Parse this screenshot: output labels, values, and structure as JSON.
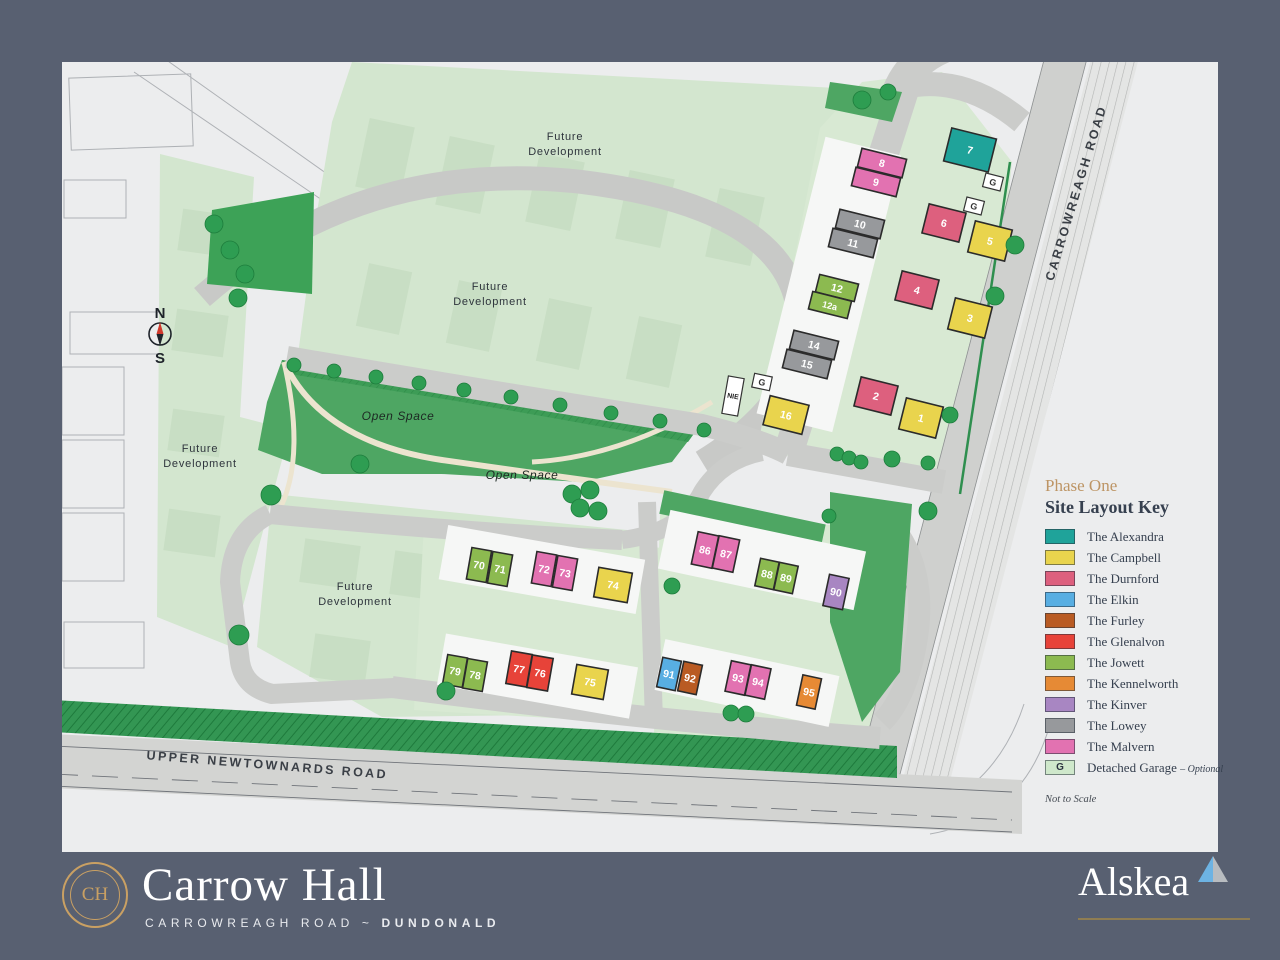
{
  "page": {
    "frame_color": "#586071",
    "map_bg": "#ecedee"
  },
  "legend": {
    "phase": "Phase One",
    "title": "Site Layout Key",
    "items": [
      {
        "name": "The Alexandra",
        "color": "#1fa39a"
      },
      {
        "name": "The Campbell",
        "color": "#e9d44d"
      },
      {
        "name": "The Durnford",
        "color": "#dd607e"
      },
      {
        "name": "The Elkin",
        "color": "#58aee2"
      },
      {
        "name": "The Furley",
        "color": "#b95b23"
      },
      {
        "name": "The Glenalvon",
        "color": "#e74339"
      },
      {
        "name": "The Jowett",
        "color": "#8cba50"
      },
      {
        "name": "The Kennelworth",
        "color": "#e68a35"
      },
      {
        "name": "The Kinver",
        "color": "#a886c2"
      },
      {
        "name": "The Lowey",
        "color": "#97999c"
      },
      {
        "name": "The Malvern",
        "color": "#e272b1"
      }
    ],
    "garage": {
      "label": "Detached Garage",
      "suffix": "– Optional",
      "symbol": "G",
      "color": "#cfe8cb"
    },
    "note": "Not to Scale"
  },
  "footer": {
    "brand": "Carrow Hall",
    "monogram": "CH",
    "tagline_road": "CARROWREAGH ROAD",
    "tagline_sep": "~",
    "tagline_town": "DUNDONALD",
    "developer": "Alskea",
    "accent_gold": "#c9a063",
    "triangle_blue": "#6db3e3",
    "triangle_gray": "#b8bcc0"
  },
  "map": {
    "labels": {
      "future_development": "Future Development",
      "open_space": "Open Space",
      "carrowreagh_road": "CARROWREAGH ROAD",
      "upper_newtownards_road": "UPPER NEWTOWNARDS ROAD",
      "substation": "NIE",
      "garage_symbol": "G",
      "compass_n": "N",
      "compass_s": "S"
    },
    "future_label_positions": [
      {
        "x": 503,
        "y": 78
      },
      {
        "x": 428,
        "y": 228
      },
      {
        "x": 138,
        "y": 390
      },
      {
        "x": 293,
        "y": 528
      }
    ],
    "open_label_positions": [
      {
        "x": 336,
        "y": 358
      },
      {
        "x": 460,
        "y": 417
      }
    ],
    "house_colors": {
      "alexandra": "#1fa39a",
      "campbell": "#e9d44d",
      "durnford": "#dd607e",
      "elkin": "#58aee2",
      "furley": "#b95b23",
      "glenalvon": "#e74339",
      "jowett": "#8cba50",
      "kennelworth": "#e68a35",
      "kinver": "#a886c2",
      "lowey": "#97999c",
      "malvern": "#e272b1"
    },
    "plots": [
      {
        "n": "1",
        "type": "campbell",
        "x": 859,
        "y": 356,
        "w": 38,
        "h": 32,
        "r": 14
      },
      {
        "n": "2",
        "type": "durnford",
        "x": 814,
        "y": 334,
        "w": 38,
        "h": 30,
        "r": 14
      },
      {
        "n": "3",
        "type": "campbell",
        "x": 908,
        "y": 256,
        "w": 38,
        "h": 32,
        "r": 14
      },
      {
        "n": "4",
        "type": "durnford",
        "x": 855,
        "y": 228,
        "w": 38,
        "h": 30,
        "r": 14
      },
      {
        "n": "5",
        "type": "campbell",
        "x": 928,
        "y": 179,
        "w": 38,
        "h": 32,
        "r": 14
      },
      {
        "n": "6",
        "type": "durnford",
        "x": 882,
        "y": 161,
        "w": 38,
        "h": 30,
        "r": 14
      },
      {
        "n": "7",
        "type": "alexandra",
        "x": 908,
        "y": 88,
        "w": 46,
        "h": 34,
        "r": 14
      },
      {
        "n": "8",
        "type": "malvern",
        "x": 820,
        "y": 101,
        "w": 46,
        "h": 19,
        "r": 14
      },
      {
        "n": "9",
        "type": "malvern",
        "x": 814,
        "y": 120,
        "w": 46,
        "h": 19,
        "r": 14
      },
      {
        "n": "10",
        "type": "lowey",
        "x": 798,
        "y": 162,
        "w": 46,
        "h": 19,
        "r": 14
      },
      {
        "n": "11",
        "type": "lowey",
        "x": 791,
        "y": 181,
        "w": 46,
        "h": 19,
        "r": 14
      },
      {
        "n": "12",
        "type": "jowett",
        "x": 775,
        "y": 226,
        "w": 40,
        "h": 18,
        "r": 14
      },
      {
        "n": "12a",
        "type": "jowett",
        "x": 768,
        "y": 243,
        "w": 40,
        "h": 18,
        "r": 14
      },
      {
        "n": "14",
        "type": "lowey",
        "x": 752,
        "y": 283,
        "w": 46,
        "h": 19,
        "r": 14
      },
      {
        "n": "15",
        "type": "lowey",
        "x": 745,
        "y": 302,
        "w": 46,
        "h": 19,
        "r": 14
      },
      {
        "n": "16",
        "type": "campbell",
        "x": 724,
        "y": 353,
        "w": 40,
        "h": 30,
        "r": 14
      },
      {
        "n": "70",
        "type": "jowett",
        "x": 417,
        "y": 503,
        "w": 20,
        "h": 32,
        "r": 10
      },
      {
        "n": "71",
        "type": "jowett",
        "x": 438,
        "y": 507,
        "w": 20,
        "h": 32,
        "r": 10
      },
      {
        "n": "72",
        "type": "malvern",
        "x": 482,
        "y": 507,
        "w": 20,
        "h": 32,
        "r": 10
      },
      {
        "n": "73",
        "type": "malvern",
        "x": 503,
        "y": 511,
        "w": 20,
        "h": 32,
        "r": 10
      },
      {
        "n": "74",
        "type": "campbell",
        "x": 551,
        "y": 523,
        "w": 34,
        "h": 30,
        "r": 10
      },
      {
        "n": "75",
        "type": "campbell",
        "x": 528,
        "y": 620,
        "w": 32,
        "h": 30,
        "r": 10
      },
      {
        "n": "76",
        "type": "glenalvon",
        "x": 478,
        "y": 611,
        "w": 21,
        "h": 33,
        "r": 10
      },
      {
        "n": "77",
        "type": "glenalvon",
        "x": 457,
        "y": 607,
        "w": 21,
        "h": 33,
        "r": 10
      },
      {
        "n": "78",
        "type": "jowett",
        "x": 413,
        "y": 613,
        "w": 20,
        "h": 30,
        "r": 10
      },
      {
        "n": "79",
        "type": "jowett",
        "x": 393,
        "y": 609,
        "w": 20,
        "h": 30,
        "r": 10
      },
      {
        "n": "86",
        "type": "malvern",
        "x": 643,
        "y": 488,
        "w": 21,
        "h": 33,
        "r": 12
      },
      {
        "n": "87",
        "type": "malvern",
        "x": 664,
        "y": 492,
        "w": 21,
        "h": 33,
        "r": 12
      },
      {
        "n": "88",
        "type": "jowett",
        "x": 705,
        "y": 512,
        "w": 19,
        "h": 28,
        "r": 12
      },
      {
        "n": "89",
        "type": "jowett",
        "x": 724,
        "y": 516,
        "w": 19,
        "h": 28,
        "r": 12
      },
      {
        "n": "90",
        "type": "kinver",
        "x": 774,
        "y": 530,
        "w": 20,
        "h": 32,
        "r": 12
      },
      {
        "n": "91",
        "type": "elkin",
        "x": 607,
        "y": 612,
        "w": 19,
        "h": 30,
        "r": 12
      },
      {
        "n": "92",
        "type": "furley",
        "x": 628,
        "y": 616,
        "w": 19,
        "h": 30,
        "r": 12
      },
      {
        "n": "93",
        "type": "malvern",
        "x": 676,
        "y": 616,
        "w": 20,
        "h": 31,
        "r": 12
      },
      {
        "n": "94",
        "type": "malvern",
        "x": 696,
        "y": 620,
        "w": 20,
        "h": 31,
        "r": 12
      },
      {
        "n": "95",
        "type": "kennelworth",
        "x": 747,
        "y": 630,
        "w": 19,
        "h": 31,
        "r": 12
      }
    ],
    "garages": [
      {
        "x": 931,
        "y": 120,
        "r": 14
      },
      {
        "x": 912,
        "y": 144,
        "r": 14
      },
      {
        "x": 700,
        "y": 320,
        "r": 12
      }
    ],
    "substation_box": {
      "x": 671,
      "y": 334,
      "r": 10
    },
    "trees": [
      [
        152,
        162,
        9
      ],
      [
        168,
        188,
        9
      ],
      [
        183,
        212,
        9
      ],
      [
        176,
        236,
        9
      ],
      [
        800,
        38,
        9
      ],
      [
        826,
        30,
        8
      ],
      [
        232,
        303,
        7
      ],
      [
        272,
        309,
        7
      ],
      [
        314,
        315,
        7
      ],
      [
        357,
        321,
        7
      ],
      [
        402,
        328,
        7
      ],
      [
        449,
        335,
        7
      ],
      [
        498,
        343,
        7
      ],
      [
        549,
        351,
        7
      ],
      [
        598,
        359,
        7
      ],
      [
        642,
        368,
        7
      ],
      [
        298,
        402,
        9
      ],
      [
        510,
        432,
        9
      ],
      [
        528,
        428,
        9
      ],
      [
        518,
        446,
        9
      ],
      [
        536,
        449,
        9
      ],
      [
        209,
        433,
        10
      ],
      [
        177,
        573,
        10
      ],
      [
        384,
        629,
        9
      ],
      [
        953,
        183,
        9
      ],
      [
        933,
        234,
        9
      ],
      [
        888,
        353,
        8
      ],
      [
        775,
        392,
        7
      ],
      [
        787,
        396,
        7
      ],
      [
        799,
        400,
        7
      ],
      [
        830,
        397,
        8
      ],
      [
        866,
        401,
        7
      ],
      [
        866,
        449,
        9
      ],
      [
        767,
        454,
        7
      ],
      [
        610,
        524,
        8
      ],
      [
        669,
        651,
        8
      ],
      [
        684,
        652,
        8
      ]
    ]
  }
}
